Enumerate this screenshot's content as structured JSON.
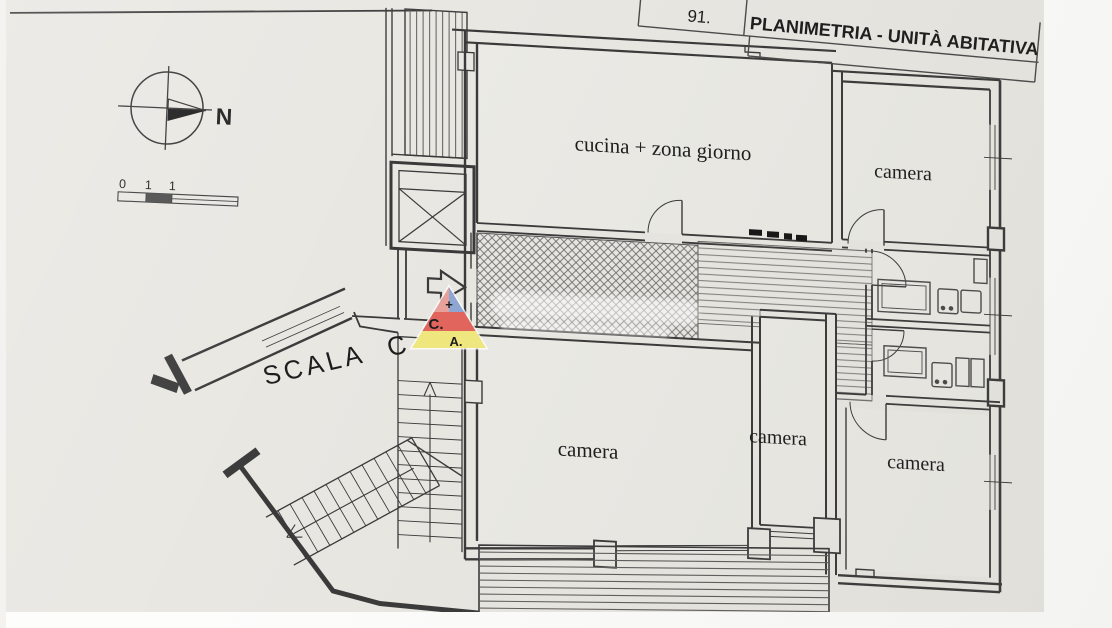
{
  "title_block": {
    "code": "91.",
    "title": "PLANIMETRIA - UNITÀ ABITATIVA"
  },
  "compass": {
    "north_label": "N"
  },
  "scale_bar": {
    "tick_labels": [
      "0",
      "1",
      "1"
    ]
  },
  "plan": {
    "stairwell_label": "SCALA C",
    "rooms": [
      {
        "id": "kitchen-living",
        "label": "cucina + zona giorno"
      },
      {
        "id": "bedroom-top-right",
        "label": "camera"
      },
      {
        "id": "bedroom-bottom-left",
        "label": "camera"
      },
      {
        "id": "bedroom-bottom-middle",
        "label": "camera"
      },
      {
        "id": "bedroom-bottom-right",
        "label": "camera"
      }
    ]
  },
  "watermark": {
    "logo_letters": [
      "+",
      "C.",
      "A."
    ]
  },
  "colors": {
    "paper": "#e9e7e2",
    "ink": "#3a3a3a",
    "logo_pink": "#e9a09b",
    "logo_blue": "#8ea7d3",
    "logo_red": "#e2655c",
    "logo_yellow": "#f0e77e",
    "logo_letter_red": "#a6322e",
    "logo_letter_blue": "#3e5fae",
    "logo_plus_green": "#2f9e62"
  }
}
